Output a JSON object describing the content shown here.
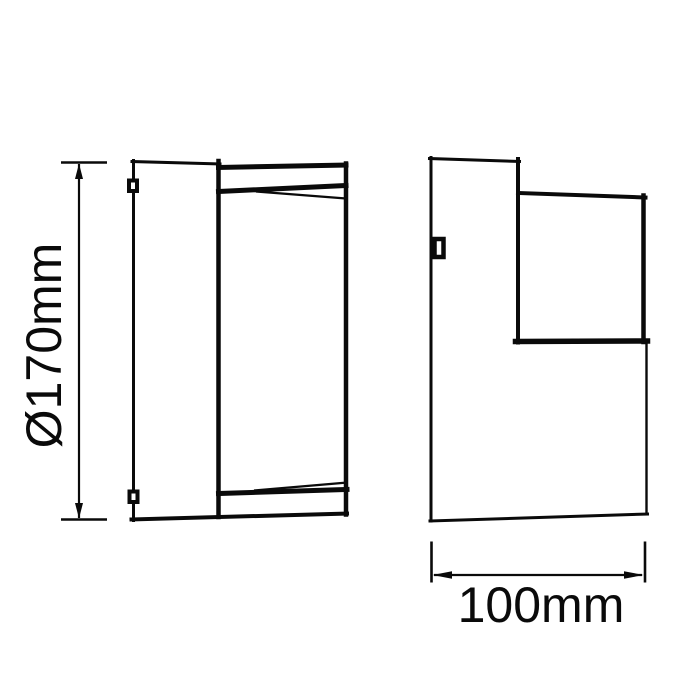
{
  "page": {
    "background_color": "#ffffff",
    "line_color": "#0a0a0a"
  },
  "diagram": {
    "type": "technical-dimension-drawing",
    "subject": "wall light fixture, two orthographic views with dimension callouts",
    "views": [
      {
        "id": "front-view",
        "description": "front elevation with wall plate, cylindrical body, top and bottom rim wedges, two mounting clips"
      },
      {
        "id": "side-view",
        "description": "side elevation with wall plate column, protruding lamp head and one mounting clip"
      }
    ],
    "dimensions": {
      "height": {
        "label": "Ø170mm",
        "value": 170,
        "unit": "mm",
        "orientation": "vertical",
        "applies_to": "front-view overall height / diameter"
      },
      "depth": {
        "label": "100mm",
        "value": 100,
        "unit": "mm",
        "orientation": "horizontal",
        "applies_to": "side-view overall depth"
      }
    }
  }
}
